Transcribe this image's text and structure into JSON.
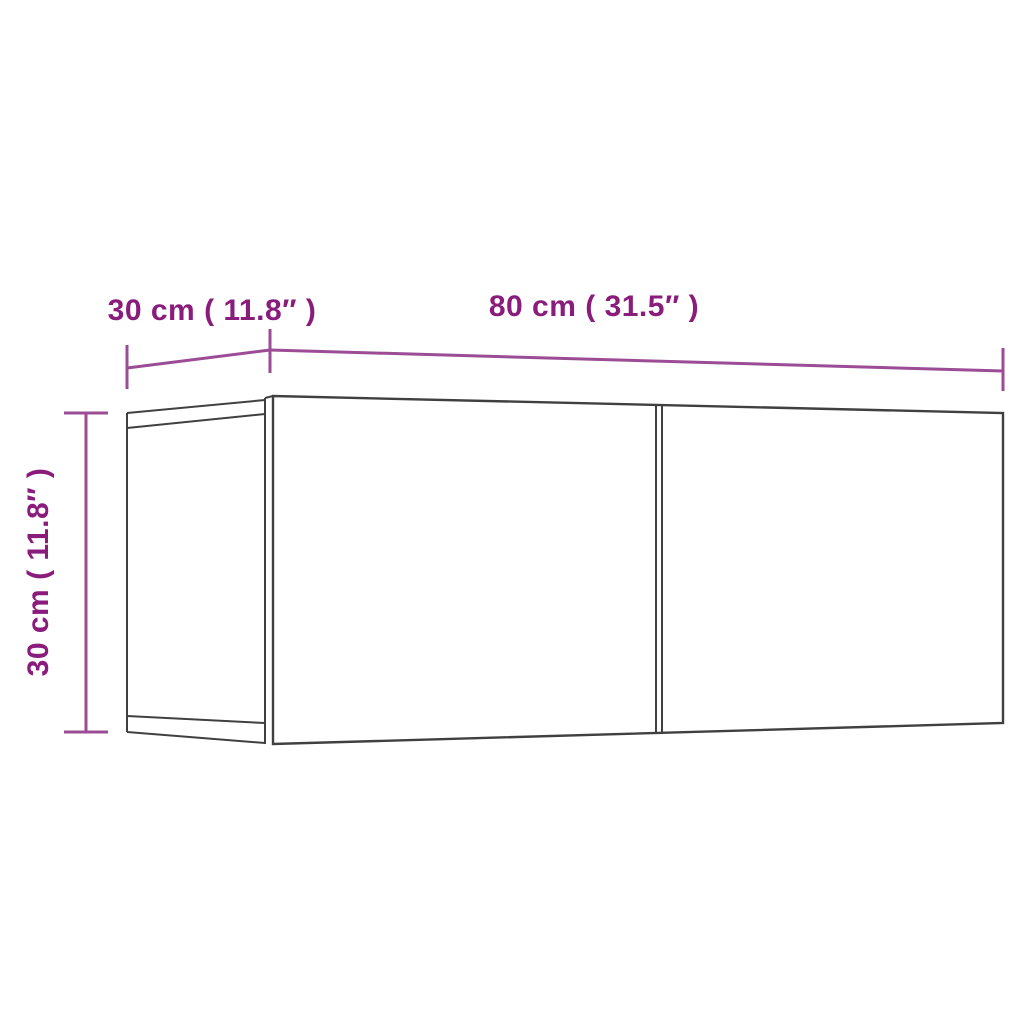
{
  "diagram": {
    "type": "furniture-dimension-drawing",
    "subject": "wall-mounted TV cabinet with two compartments",
    "labels": {
      "top_depth": "30 cm ( 11.8″ )",
      "front_width": "80 cm ( 31.5″ )",
      "height": "30 cm ( 11.8″ )"
    },
    "dimensions": {
      "depth_cm": 30,
      "depth_in": 11.8,
      "width_cm": 80,
      "width_in": 31.5,
      "height_cm": 30,
      "height_in": 11.8
    }
  },
  "colors": {
    "background": "#ffffff",
    "cabinet_line": "#404040",
    "dimension_line": "#9b4c95",
    "dimension_text": "#8a1c7c"
  }
}
